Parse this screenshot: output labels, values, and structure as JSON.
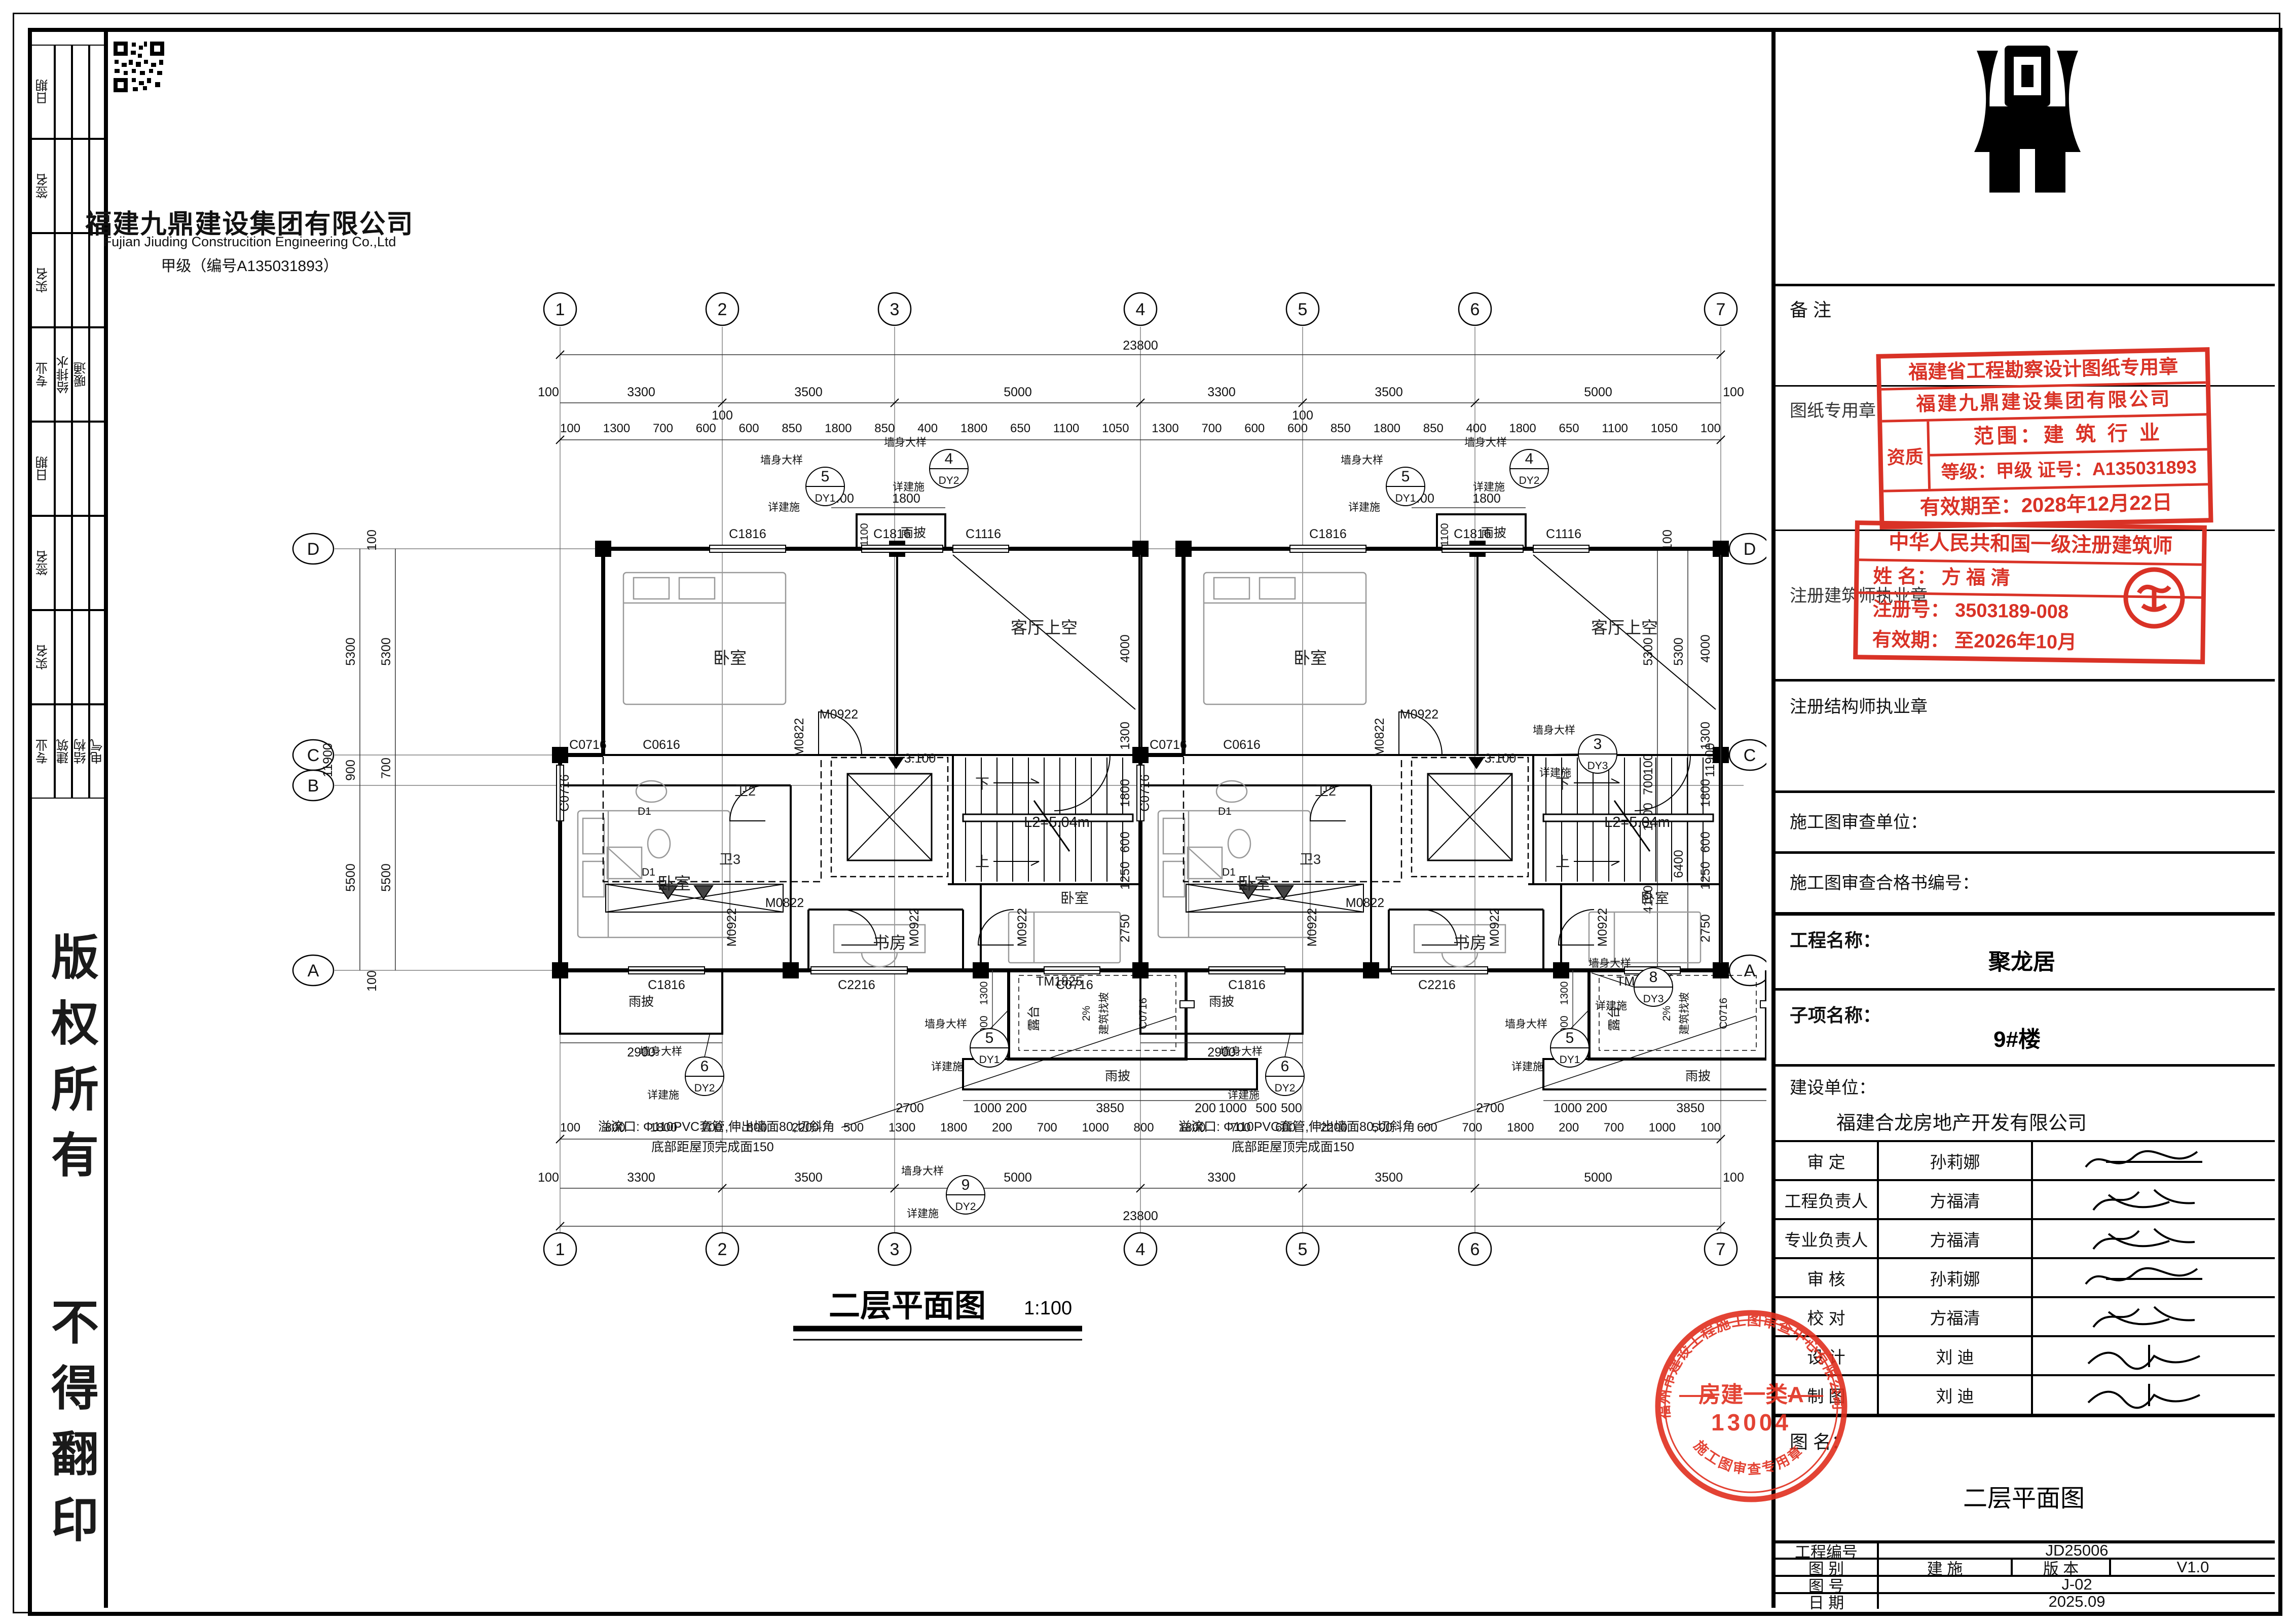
{
  "colors": {
    "stamp_red": "#d93226",
    "round_stamp_red": "#e02f1f",
    "line": "#000000"
  },
  "sidebar": {
    "h_date": "日期",
    "h_sign": "签名",
    "h_name": "实名",
    "h_major": "专业",
    "majors1": [
      "给排水",
      "暖通"
    ],
    "majors2": [
      "建筑",
      "结构",
      "电气"
    ],
    "copyright1": "版权所有",
    "copyright2": "不得翻印"
  },
  "titleblock": {
    "company_cn": "福建九鼎建设集团有限公司",
    "company_en": "Fujian Jiuding Construcition Engineering Co.,Ltd",
    "grade_line": "甲级（编号A135031893）",
    "remark_label": "备 注",
    "sheet_seal_label": "图纸专用章",
    "stamp1": {
      "line1": "福建省工程勘察设计图纸专用章",
      "line2": "福建九鼎建设集团有限公司",
      "zizhi": "资质",
      "scope": "范围：建 筑 行 业",
      "grade": "等级：甲级 证号：A135031893",
      "valid": "有效期至：2028年12月22日"
    },
    "arch_seal_label": "注册建筑师执业章",
    "stamp2": {
      "line1": "中华人民共和国一级注册建筑师",
      "name_line": "姓  名：  方 福 清",
      "reg_line": "注册号：  3503189-008",
      "valid_line": "有效期：  至2026年10月"
    },
    "struct_seal_label": "注册结构师执业章",
    "review_unit_label": "施工图审查单位：",
    "review_no_label": "施工图审查合格书编号：",
    "project_label": "工程名称：",
    "project": "聚龙居",
    "sub_label": "子项名称：",
    "sub": "9#楼",
    "client_label": "建设单位：",
    "client": "福建合龙房地产开发有限公司",
    "signoff": [
      {
        "role": "审  定",
        "name": "孙莉娜"
      },
      {
        "role": "工程负责人",
        "name": "方福清"
      },
      {
        "role": "专业负责人",
        "name": "方福清"
      },
      {
        "role": "审  核",
        "name": "孙莉娜"
      },
      {
        "role": "校  对",
        "name": "方福清"
      },
      {
        "role": "设  计",
        "name": "刘  迪"
      },
      {
        "role": "制  图",
        "name": "刘  迪"
      }
    ],
    "fig_label": "图 名：",
    "fig_name": "二层平面图",
    "bottom": {
      "no_label": "工程编号",
      "no": "JD25006",
      "cat_label": "图  别",
      "cat": "建  施",
      "ver_label": "版  本",
      "ver": "V1.0",
      "sheet_label": "图  号",
      "sheet": "J-02",
      "date_label": "日  期",
      "date": "2025.09"
    },
    "round_stamp": {
      "arc_top": "福州市建设工程施工图审查中心有限公司",
      "line1": "房建一类A",
      "line2": "13004",
      "arc_bottom": "施工图审查专用章"
    }
  },
  "plan": {
    "title": "二层平面图",
    "scale": "1:100",
    "grid": [
      "1",
      "2",
      "3",
      "4",
      "5",
      "6",
      "7"
    ],
    "rows": [
      "D",
      "C",
      "B",
      "A"
    ],
    "total_w": "23800",
    "total_h": "11900",
    "margin": "100",
    "major_top": [
      "100",
      "3300",
      "3500",
      "5000",
      "3300",
      "3500",
      "5000",
      "100"
    ],
    "detail_top": [
      "100",
      "1300",
      "700",
      "600",
      "600",
      "850",
      "1800",
      "850",
      "400",
      "1800",
      "650",
      "1100",
      "1050",
      "1300",
      "700",
      "600",
      "600",
      "850",
      "1800",
      "850",
      "400",
      "1800",
      "650",
      "1100",
      "1050",
      "100"
    ],
    "major_bottom": [
      "100",
      "3300",
      "3500",
      "5000",
      "3300",
      "3500",
      "5000",
      "100"
    ],
    "detail_bottom": [
      "100",
      "800",
      "1800",
      "700",
      "800",
      "2200",
      "500",
      "1300",
      "1800",
      "200",
      "700",
      "1000",
      "800",
      "1800",
      "700",
      "600",
      "2200",
      "500",
      "600",
      "700",
      "1800",
      "200",
      "700",
      "1000",
      "100"
    ],
    "left_chain": [
      "5300",
      "900",
      "5500"
    ],
    "left_chain2": [
      "5300",
      "700",
      "5500"
    ],
    "right_chain": [
      "5300",
      "100",
      "700",
      "1500",
      "4100"
    ],
    "right_chain2": [
      "5300",
      "6400"
    ],
    "mid_chain": [
      "4000",
      "1300",
      "1800",
      "600",
      "1250",
      "2750"
    ],
    "level": "3.100",
    "stair_len": "L2=5.04m",
    "down": "下",
    "up": "上",
    "bedroom": "卧室",
    "study": "书房",
    "living_void": "客厅上空",
    "bath2": "卫2",
    "bath3": "卫3",
    "terrace": "露台",
    "canopy": "雨披",
    "slope_pct": "2%",
    "slope_txt": "建筑找坡",
    "c1816": "C1816",
    "c1116": "C1116",
    "c2216": "C2216",
    "c0716": "C0716",
    "c0616": "C0616",
    "m0922": "M0922",
    "m0822": "M0822",
    "tm1825": "TM1825",
    "d1": "D1",
    "wall_detail": "墙身大样",
    "see_arch": "详建施",
    "callouts": {
      "c3": {
        "num": "3",
        "ref": "DY3"
      },
      "c4": {
        "num": "4",
        "ref": "DY2"
      },
      "c5": {
        "num": "5",
        "ref": "DY1"
      },
      "c6": {
        "num": "6",
        "ref": "DY2"
      },
      "c8": {
        "num": "8",
        "ref": "DY3"
      },
      "c9": {
        "num": "9",
        "ref": "DY2"
      }
    },
    "canopy_off": "400",
    "canopy_w": "1800",
    "canopy_h": "1100",
    "canopy_left_w": "2900",
    "terrace_side": [
      "1300",
      "900",
      "700"
    ],
    "terrace_bottom": [
      "1000",
      "200",
      "3850",
      "200",
      "1000"
    ],
    "d500a": "500",
    "d500b": "500",
    "d2700": "2700",
    "extra100": "100",
    "note_line1": "溢流口: Φ110PVC套管,伸出墙面80,切斜角",
    "note_line2": "底部距屋顶完成面150"
  }
}
